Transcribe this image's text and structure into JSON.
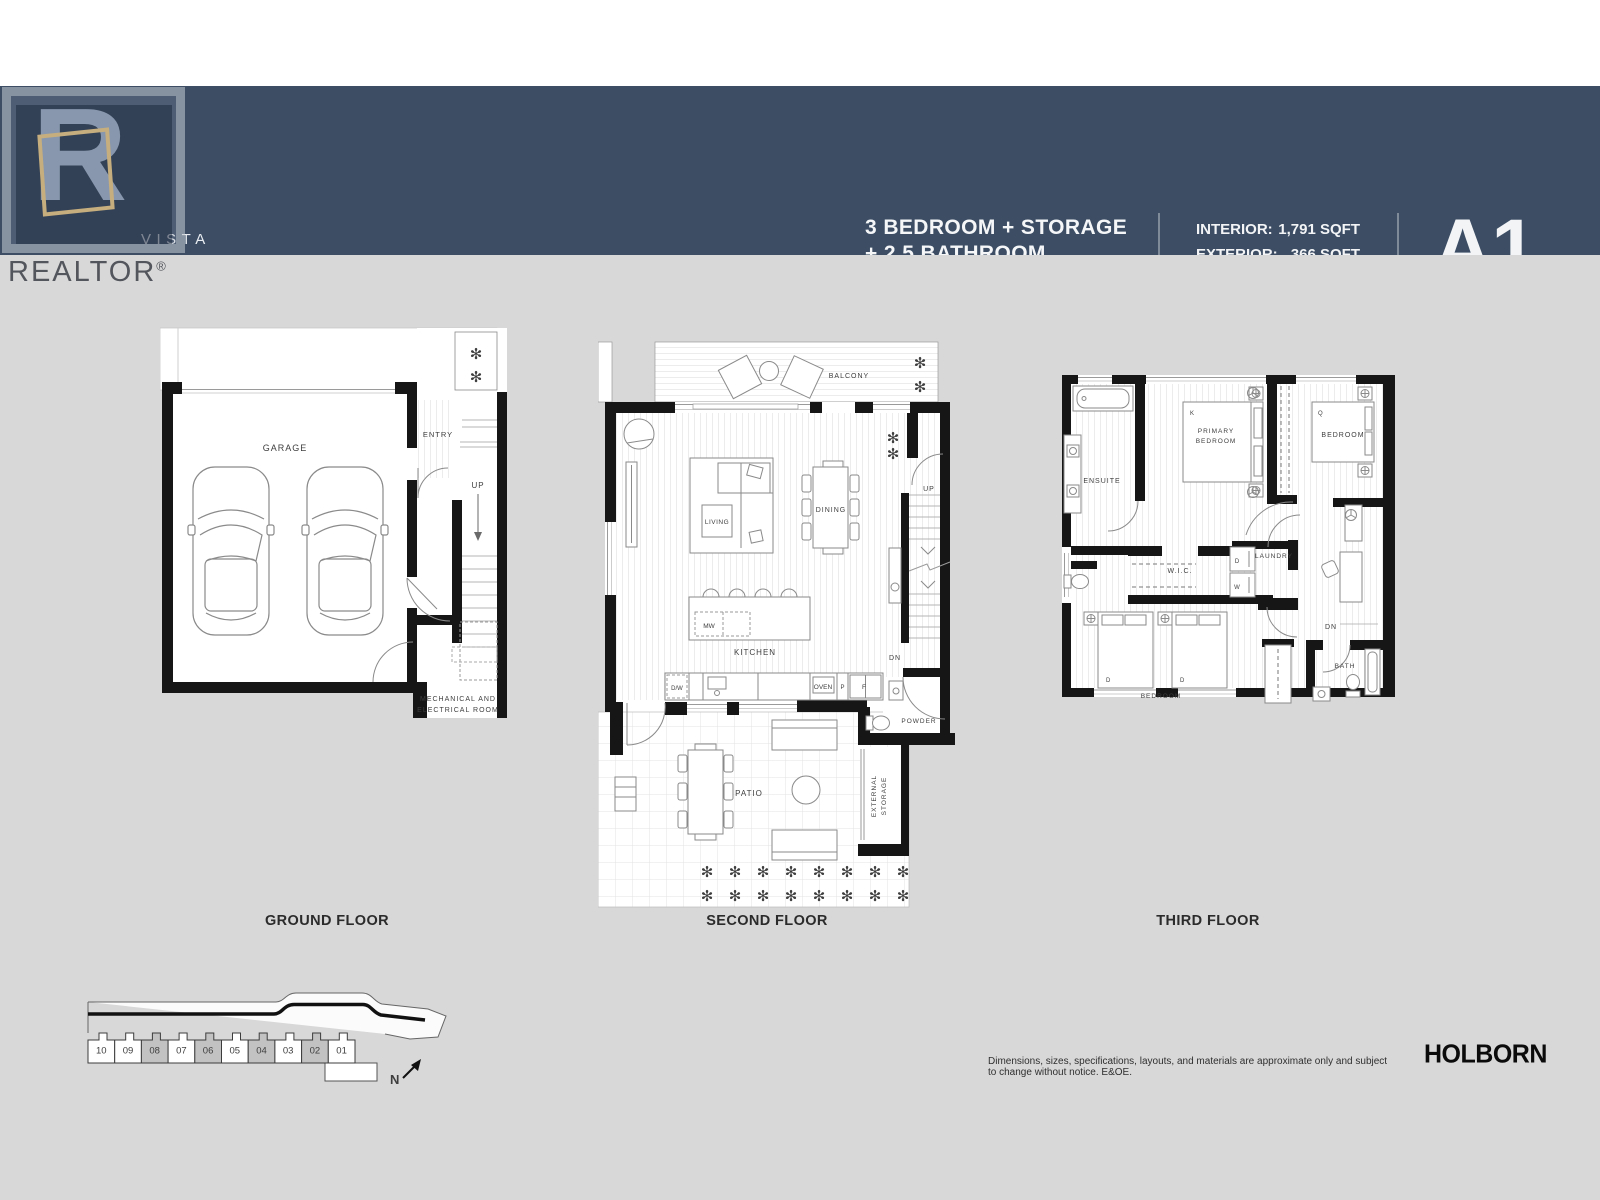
{
  "header": {
    "brand_line1": "VISTA",
    "brand_line2": "TOWNHOMES",
    "unit_line1": "3 BEDROOM + STORAGE",
    "unit_line2": "+ 2.5 BATHROOM",
    "stats": [
      {
        "label": "INTERIOR:",
        "value": "1,791 SQFT"
      },
      {
        "label": "EXTERIOR:",
        "value": "366 SQFT"
      },
      {
        "label": "TOTAL:",
        "value": "2,157 SQFT"
      }
    ],
    "plan_code": "A1"
  },
  "watermark": {
    "brand": "REALTOR",
    "reg": "®",
    "letter": "R"
  },
  "icons": {
    "plant": "✻"
  },
  "ground": {
    "title": "GROUND FLOOR",
    "labels": {
      "garage": "GARAGE",
      "entry": "ENTRY",
      "up": "UP",
      "mech1": "MECHANICAL AND",
      "mech2": "ELECTRICAL ROOM"
    }
  },
  "second": {
    "title": "SECOND FLOOR",
    "labels": {
      "balcony": "BALCONY",
      "living": "LIVING",
      "dining": "DINING",
      "up": "UP",
      "dn": "DN",
      "mw": "MW",
      "kitchen": "KITCHEN",
      "dw": "D/W",
      "oven": "OVEN",
      "p": "P",
      "f": "F",
      "powder": "POWDER",
      "patio": "PATIO",
      "ext1": "EXTERNAL",
      "ext2": "STORAGE"
    }
  },
  "third": {
    "title": "THIRD FLOOR",
    "labels": {
      "ensuite": "ENSUITE",
      "primary1": "PRIMARY",
      "primary2": "BEDROOM",
      "k": "K",
      "q": "Q",
      "bedroom_right": "BEDROOM",
      "wic": "W.I.C.",
      "laundry": "LAUNDRY",
      "dryer": "D",
      "washer": "W",
      "dn": "DN",
      "bath": "BATH",
      "bedroom_bottom": "BEDROOM",
      "bed_d1": "D",
      "bed_d2": "D"
    }
  },
  "siteplan": {
    "units": [
      "10",
      "09",
      "08",
      "07",
      "06",
      "05",
      "04",
      "03",
      "02",
      "01"
    ],
    "highlighted_units": [
      "08",
      "06",
      "04",
      "02"
    ],
    "north_label": "N"
  },
  "footer": {
    "disclaimer": "Dimensions, sizes, specifications, layouts, and materials are approximate only and subject to change without notice. E&OE.",
    "brand": "HOLBORN"
  }
}
